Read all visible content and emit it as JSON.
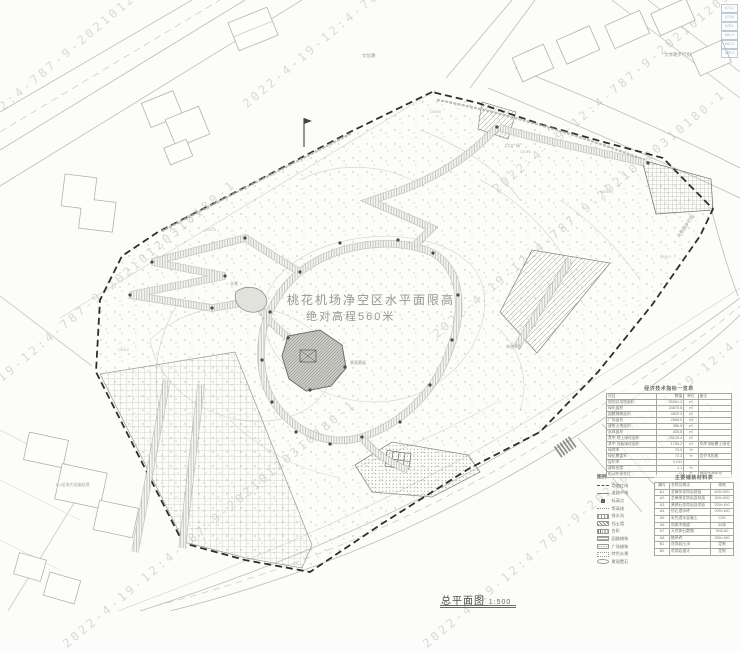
{
  "watermark": {
    "full": "2022-4-19-12:4-787-9-20210120310180-1",
    "date": "2022-4-19-12:4",
    "serial": "20210120310180-1"
  },
  "title_block": {
    "title": "总平面图",
    "scale": "1:500"
  },
  "airport_note": {
    "line1": "桃花机场净空区水平面限高",
    "line2": "绝对高程560米"
  },
  "street_labels": {
    "top": "文化路",
    "top_right": "文体路步行街",
    "right_side": "文体路步行街"
  },
  "area_labels": {
    "power_block": "8-2区电力设施信息",
    "entrance": "入口广场",
    "rest": "休息平台",
    "gallery": "景观廊架",
    "pond": "水景"
  },
  "spot_elevations": [
    "1013.6",
    "1015.2",
    "1018.4",
    "1009.8",
    "1021.5",
    "1016.0"
  ],
  "corner_marks": [
    "673.2",
    "675.8",
    "678.1",
    "680.4",
    "682.9",
    "685.3"
  ],
  "econ_table": {
    "title": "经济技术指标一览表",
    "rows": [
      {
        "n": "项目",
        "v": "数值",
        "u": "单位",
        "r": "备注"
      },
      {
        "n": "规划总用地面积",
        "v": "35261.2",
        "u": "㎡",
        "r": ""
      },
      {
        "n": "绿化面积",
        "v": "24875.6",
        "u": "㎡",
        "r": ""
      },
      {
        "n": "园路铺装面积",
        "v": "4820.3",
        "u": "㎡",
        "r": ""
      },
      {
        "n": "广场面积",
        "v": "2665.0",
        "u": "㎡",
        "r": ""
      },
      {
        "n": "建筑占地面积",
        "v": "386.5",
        "u": "㎡",
        "r": ""
      },
      {
        "n": "水体面积",
        "v": "420.8",
        "u": "㎡",
        "r": ""
      },
      {
        "n": "其中 地上绿化面积",
        "v": "23120.4",
        "u": "㎡",
        "r": ""
      },
      {
        "n": "其中 顶板绿化面积",
        "v": "1755.2",
        "u": "㎡",
        "r": "车库顶板覆土绿化"
      },
      {
        "n": "绿地率",
        "v": "70.5",
        "u": "%",
        "r": ""
      },
      {
        "n": "绿化覆盖率",
        "v": "72.3",
        "u": "%",
        "r": "含乔木投影"
      },
      {
        "n": "容积率",
        "v": "0.011",
        "u": "",
        "r": ""
      },
      {
        "n": "建筑密度",
        "v": "1.1",
        "u": "%",
        "r": ""
      },
      {
        "n": "机动车停车位",
        "v": "12",
        "u": "个",
        "r": "地面生态车位"
      }
    ]
  },
  "legend": {
    "title": "图例",
    "items": [
      {
        "sym": "redline",
        "label": "用地红线"
      },
      {
        "sym": "centerline",
        "label": "道路中线"
      },
      {
        "sym": "spot",
        "label": "标高点"
      },
      {
        "sym": "contour",
        "label": "等高线"
      },
      {
        "sym": "ditch",
        "label": "排水沟"
      },
      {
        "sym": "wall",
        "label": "挡土墙"
      },
      {
        "sym": "steps",
        "label": "台阶"
      },
      {
        "sym": "paving",
        "label": "园路铺装"
      },
      {
        "sym": "plaza",
        "label": "广场铺装"
      },
      {
        "sym": "water",
        "label": "特色水景"
      },
      {
        "sym": "stone",
        "label": "景观置石"
      }
    ]
  },
  "material_table": {
    "title": "主要铺装材料表",
    "rows": [
      {
        "c": "编号",
        "n": "名称及做法",
        "s": "规格"
      },
      {
        "c": "A1",
        "n": "芝麻灰花岗岩烧面",
        "s": "600×300"
      },
      {
        "c": "A2",
        "n": "芝麻黑花岗岩荔枝面",
        "s": "300×300"
      },
      {
        "c": "A3",
        "n": "黄锈石花岗岩自然面",
        "s": "200×100"
      },
      {
        "c": "A4",
        "n": "仿石透水砖",
        "s": "200×100"
      },
      {
        "c": "A5",
        "n": "彩色透水混凝土",
        "s": "C25"
      },
      {
        "c": "A6",
        "n": "防腐木栈道",
        "s": "30厚"
      },
      {
        "c": "A7",
        "n": "天然卵石散铺",
        "s": "Φ40-60"
      },
      {
        "c": "A8",
        "n": "植草砖",
        "s": "250×190"
      },
      {
        "c": "B1",
        "n": "花岗岩压顶",
        "s": "定制"
      },
      {
        "c": "B2",
        "n": "花岗岩道牙",
        "s": "定制"
      }
    ]
  }
}
